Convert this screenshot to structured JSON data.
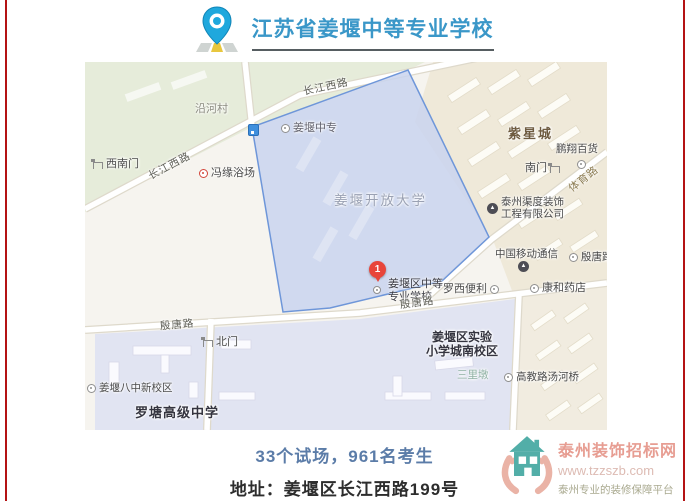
{
  "page": {
    "width": 689,
    "height": 501,
    "side_border_color": "#b41314",
    "background": "#ffffff"
  },
  "header": {
    "logo_icon": "map-pin-icon",
    "title": "江苏省姜堰中等专业学校",
    "title_color": "#3a97c8"
  },
  "map": {
    "marker": {
      "number": "1",
      "label_line1": "姜堰区中等",
      "label_line2": "专业学校",
      "color": "#e8453a"
    },
    "highlight_polygon_color": "#6e96d9",
    "roads": {
      "changjiang_top": "长江西路",
      "changjiang_left": "长江西路",
      "yintang_left": "殷唐路",
      "yintang_mid": "殷唐路",
      "tiyu": "体育路"
    },
    "areas": {
      "open_university": "姜堰开放大学",
      "zixingcheng": "紫星城",
      "luotang_school": "罗塘高级中学",
      "shiyan_line1": "姜堰区实验",
      "shiyan_line2": "小学城南校区"
    },
    "pois": {
      "yanhe_village": "沿河村",
      "southwest_gate": "西南门",
      "fengyuan_bath": "冯缘浴场",
      "jiangyan_zhongzhuan": "姜堰中专",
      "pengxiang_store": "鹏翔百货",
      "south_gate": "南门",
      "taizhou_decor_line1": "泰州渠度装饰",
      "taizhou_decor_line2": "工程有限公司",
      "china_mobile": "中国移动通信",
      "kanghe_pharmacy": "康和药店",
      "yintang_stop": "殷唐路",
      "luoxi_store": "罗西便利",
      "north_gate": "北门",
      "bazhong_campus": "姜堰八中新校区",
      "sanlidun": "三里墩",
      "gaojiao_bridge": "高教路汤河桥"
    }
  },
  "footer": {
    "stats": "33个试场，961名考生",
    "stats_color": "#5b7ca8",
    "address": "地址：姜堰区长江西路199号"
  },
  "watermark": {
    "logo_icon": "hands-holding-house-icon",
    "site_name": "泰州装饰招标网",
    "url": "www.tzzszb.com",
    "tagline": "泰州专业的装修保障平台",
    "name_color": "#e79d92",
    "house_color": "#52aea8",
    "hands_color": "#eab3a6"
  }
}
